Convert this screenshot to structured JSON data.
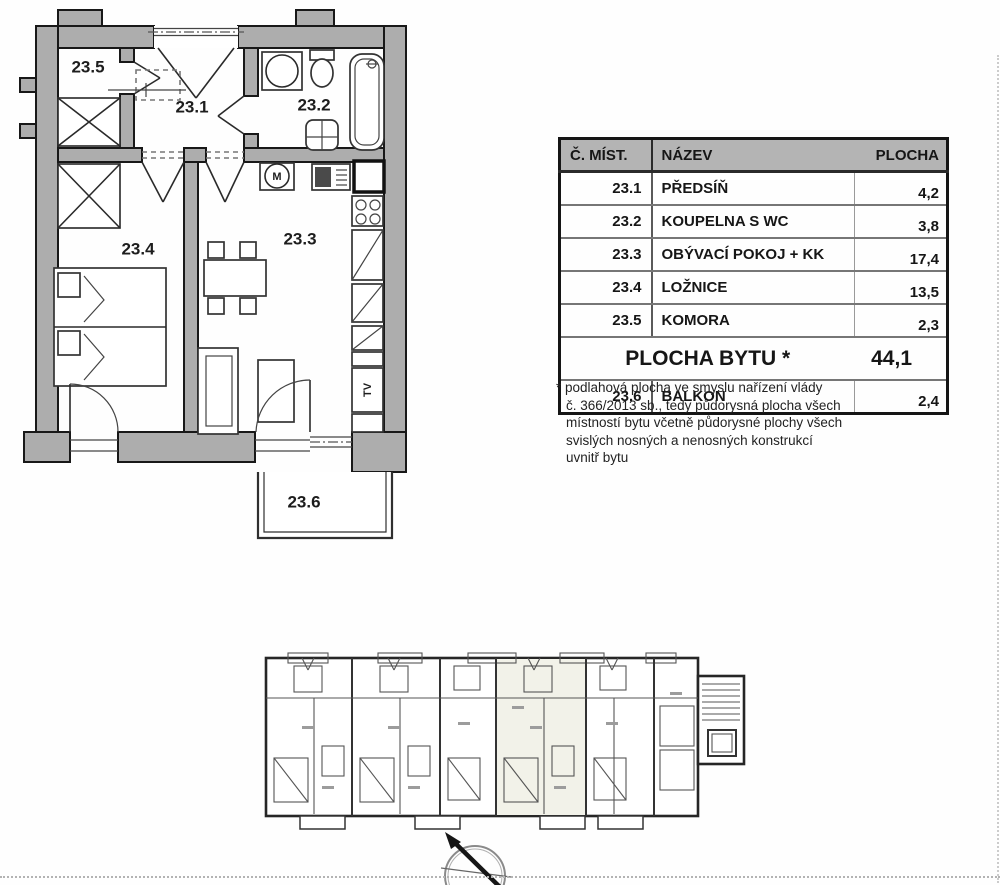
{
  "floor_plan": {
    "labels": {
      "hall": "23.1",
      "bathroom": "23.2",
      "living": "23.3",
      "bedroom": "23.4",
      "storage": "23.5",
      "balcony": "23.6"
    },
    "appliances": {
      "washing_machine": "M",
      "tv": "TV"
    }
  },
  "area_table": {
    "headers": {
      "room_number": "Č. MÍST.",
      "name": "NÁZEV",
      "area": "PLOCHA"
    },
    "rows": [
      {
        "number": "23.1",
        "name": "PŘEDSÍŇ",
        "area": "4,2"
      },
      {
        "number": "23.2",
        "name": "KOUPELNA S WC",
        "area": "3,8"
      },
      {
        "number": "23.3",
        "name": "OBÝVACÍ POKOJ + KK",
        "area": "17,4"
      },
      {
        "number": "23.4",
        "name": "LOŽNICE",
        "area": "13,5"
      },
      {
        "number": "23.5",
        "name": "KOMORA",
        "area": "2,3"
      }
    ],
    "total_row": {
      "label": "PLOCHA BYTU *",
      "value": "44,1"
    },
    "balcony_row": {
      "number": "23.6",
      "name": "BALKON",
      "area": "2,4"
    }
  },
  "footnote": {
    "lines": [
      "* podlahová plocha ve smyslu nařízení vlády",
      "č. 366/2013 sb., tedy půdorysná plocha všech",
      "místností bytu včetně půdorysné plochy všech",
      "svislých nosných a nenosných konstrukcí",
      "uvnitř bytu"
    ]
  },
  "colors": {
    "wall_fill": "#adadad",
    "table_header_bg": "#b4b4b4",
    "line": "#1a1a1a"
  }
}
